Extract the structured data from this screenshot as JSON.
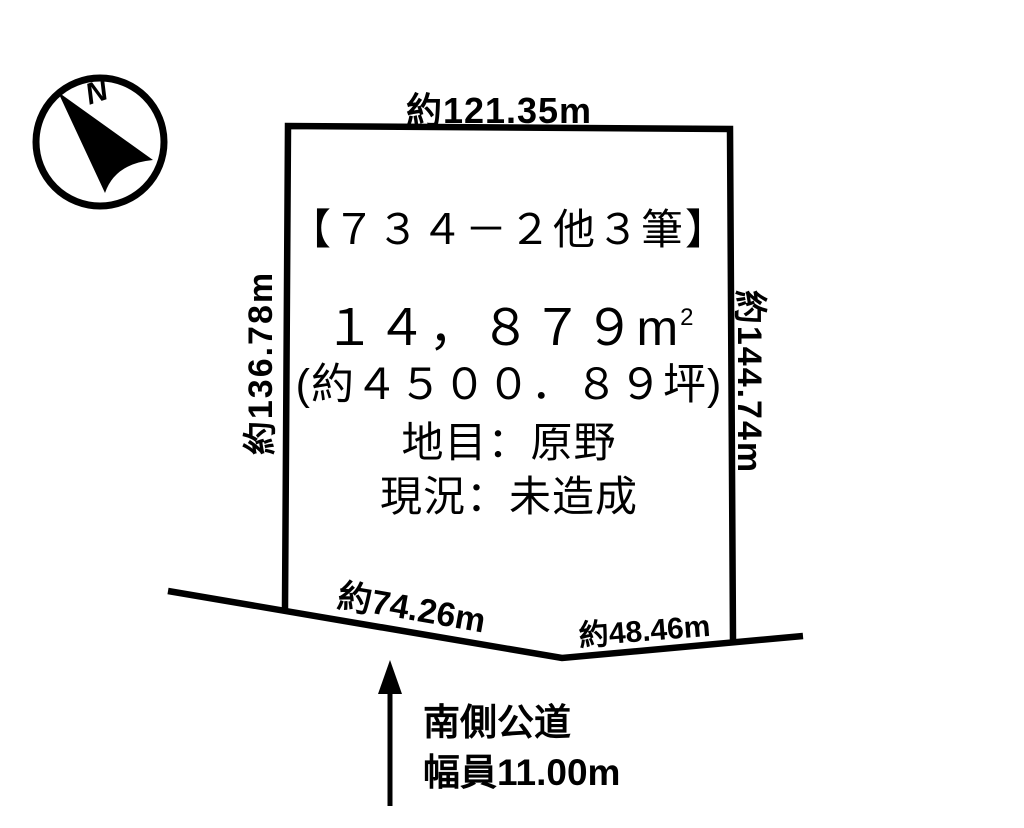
{
  "diagram": {
    "compass": {
      "north_label": "N"
    },
    "parcel": {
      "title": "【７３４－２他３筆】",
      "area_value": "１４，８７９",
      "area_unit": "m",
      "area_exponent": "2",
      "area_tsubo": "(約４５００．８９坪)",
      "land_category": "地目：原野",
      "current_state": "現況：未造成"
    },
    "dimensions": {
      "top": "約121.35m",
      "left": "約136.78m",
      "right": "約144.74m",
      "bottom_left": "約74.26m",
      "bottom_right": "約48.46m"
    },
    "road": {
      "line1": "南側公道",
      "line2": "幅員11.00m"
    },
    "colors": {
      "line": "#000000",
      "background": "#ffffff",
      "text": "#000000"
    }
  }
}
